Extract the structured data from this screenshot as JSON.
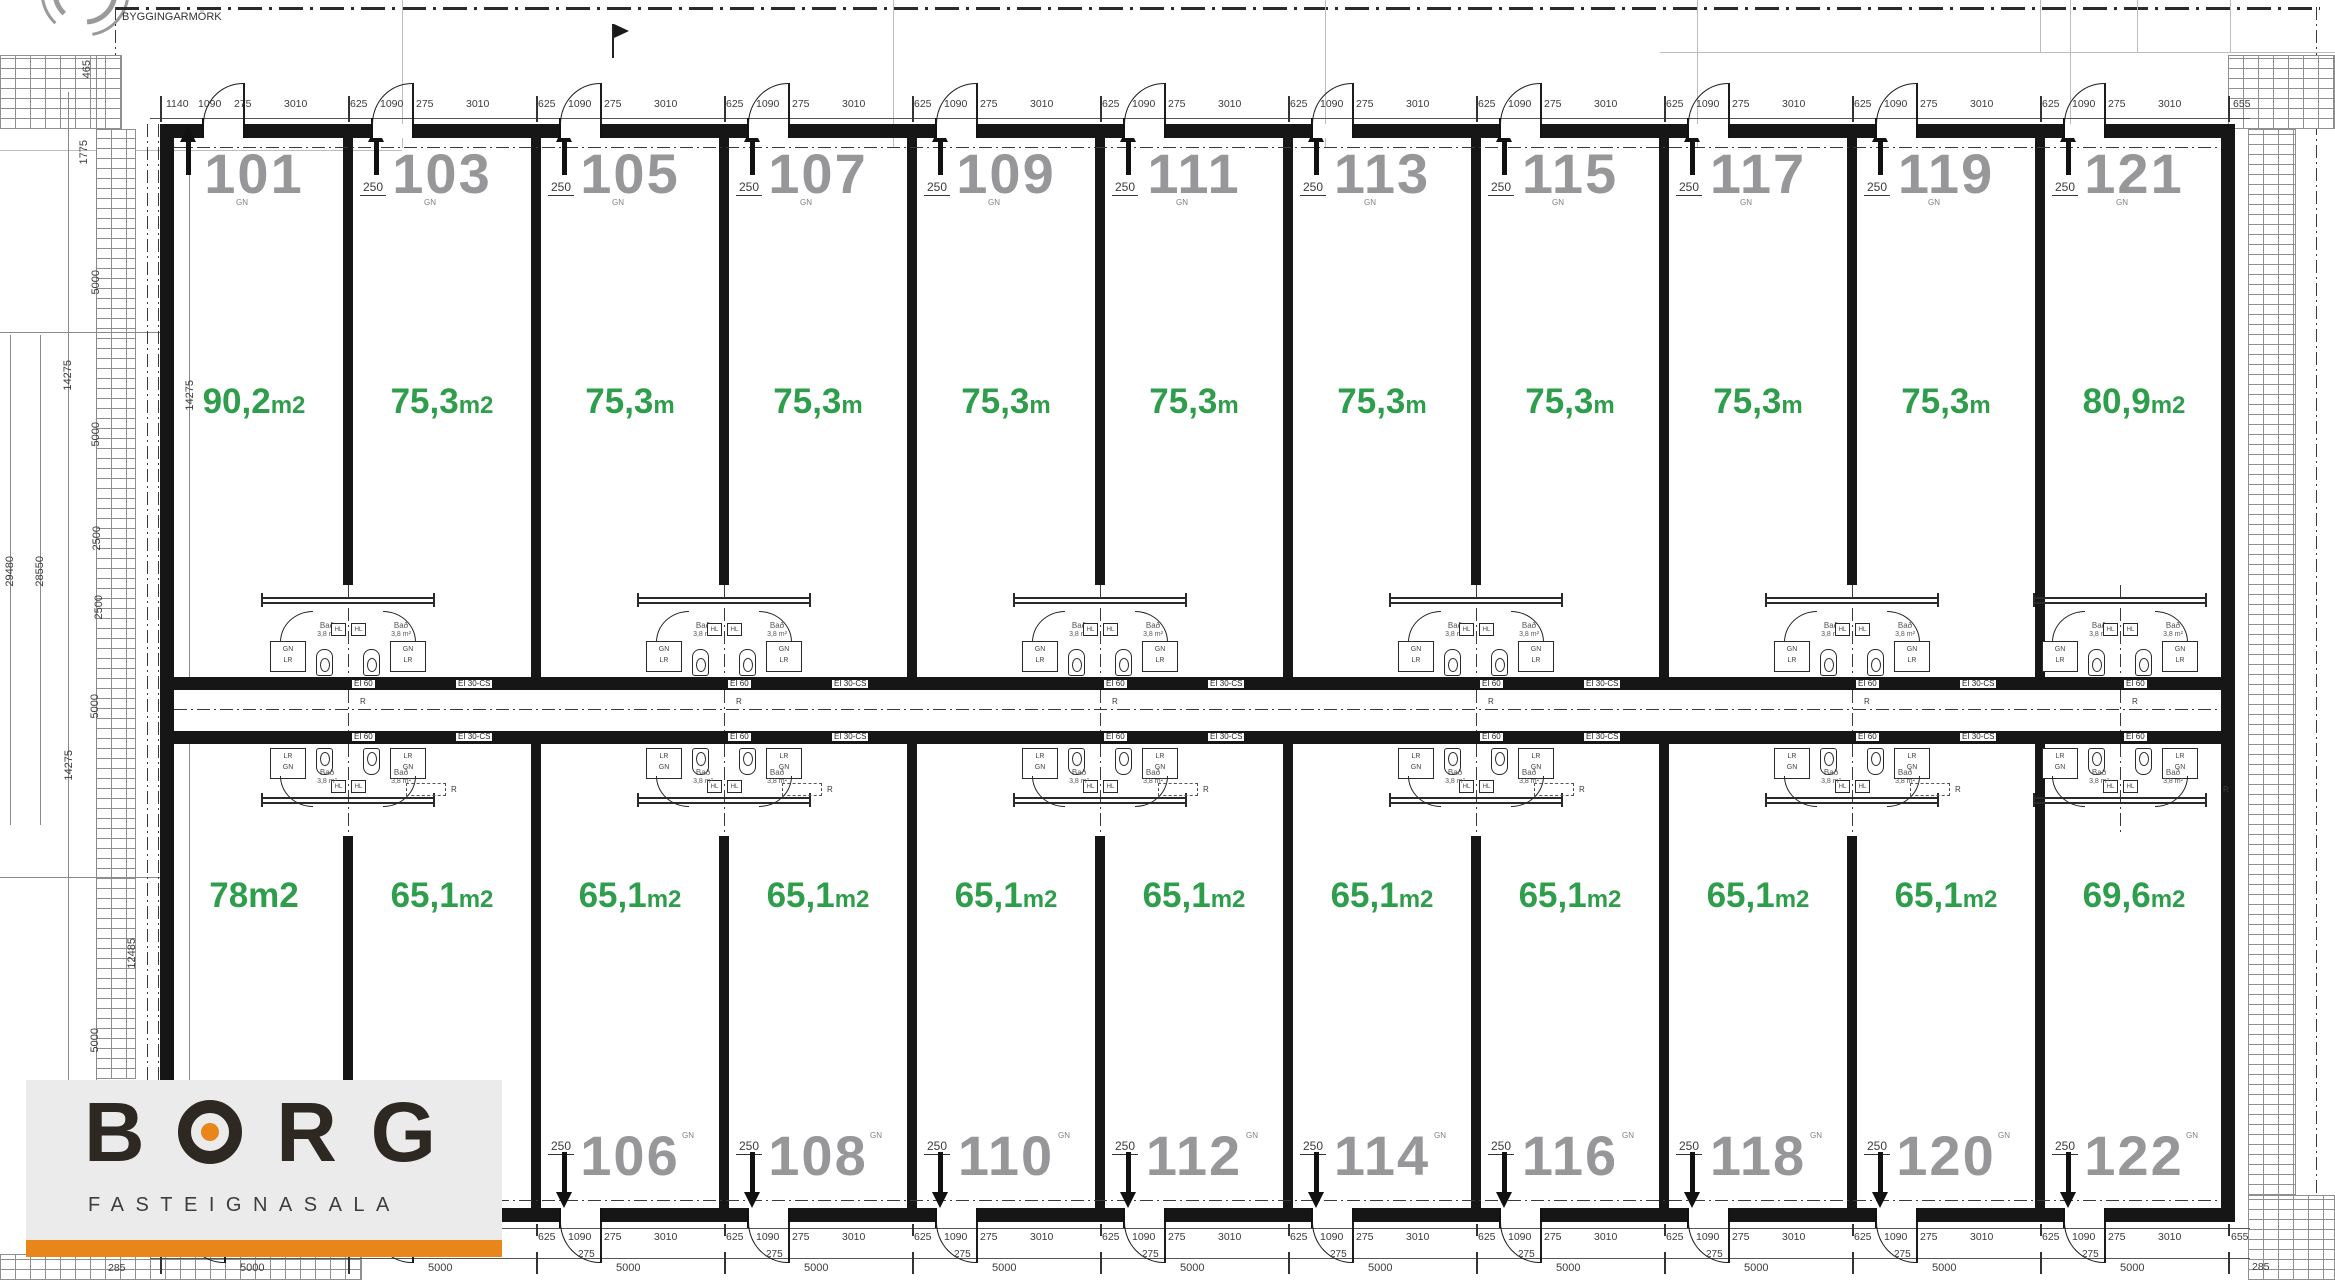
{
  "boundary": {
    "label": "BYGGINGARMÖRK"
  },
  "logo": {
    "name": "BORG",
    "subtitle": "FASTEIGNASALA",
    "accent_color": "#E8861C",
    "text_color": "#2E2823"
  },
  "colors": {
    "area_green": "#2F9E4C",
    "number_gray": "#97979A",
    "wall_black": "#161616"
  },
  "corridor": {
    "room_number": "0123",
    "room_name": "Gangur",
    "room_area": "72,8 m²",
    "width_dim": "1540",
    "fire_label_a": "EI 60",
    "fire_label_b": "EI 30-CS",
    "r_label": "R"
  },
  "bath_pod": {
    "room_name": "Bað",
    "room_area": "3,8 m²",
    "closet_a": "GN",
    "closet_b": "LR",
    "fixture_box": "HL"
  },
  "shared_dims": {
    "wall_dim": "250",
    "gn_label": "GN",
    "door_dim": "275",
    "unit_width_dim": "5000"
  },
  "top_row": {
    "units": [
      {
        "number": "101",
        "area_value": "90,2",
        "area_unit": "m2",
        "unit_small": true,
        "dims": [
          "1140",
          "1090",
          "275",
          "3010"
        ]
      },
      {
        "number": "103",
        "area_value": "75,3",
        "area_unit": "m2",
        "unit_small": true,
        "dims": [
          "625",
          "1090",
          "275",
          "3010"
        ]
      },
      {
        "number": "105",
        "area_value": "75,3",
        "area_unit": "m",
        "unit_small": true,
        "dims": [
          "625",
          "1090",
          "275",
          "3010"
        ]
      },
      {
        "number": "107",
        "area_value": "75,3",
        "area_unit": "m",
        "unit_small": true,
        "dims": [
          "625",
          "1090",
          "275",
          "3010"
        ]
      },
      {
        "number": "109",
        "area_value": "75,3",
        "area_unit": "m",
        "unit_small": true,
        "dims": [
          "625",
          "1090",
          "275",
          "3010"
        ]
      },
      {
        "number": "111",
        "area_value": "75,3",
        "area_unit": "m",
        "unit_small": true,
        "dims": [
          "625",
          "1090",
          "275",
          "3010"
        ]
      },
      {
        "number": "113",
        "area_value": "75,3",
        "area_unit": "m",
        "unit_small": true,
        "dims": [
          "625",
          "1090",
          "275",
          "3010"
        ]
      },
      {
        "number": "115",
        "area_value": "75,3",
        "area_unit": "m",
        "unit_small": true,
        "dims": [
          "625",
          "1090",
          "275",
          "3010"
        ]
      },
      {
        "number": "117",
        "area_value": "75,3",
        "area_unit": "m",
        "unit_small": true,
        "dims": [
          "625",
          "1090",
          "275",
          "3010"
        ]
      },
      {
        "number": "119",
        "area_value": "75,3",
        "area_unit": "m",
        "unit_small": true,
        "dims": [
          "625",
          "1090",
          "275",
          "3010"
        ]
      },
      {
        "number": "121",
        "area_value": "80,9",
        "area_unit": "m2",
        "unit_small": true,
        "dims": [
          "625",
          "1090",
          "275",
          "3010"
        ]
      }
    ]
  },
  "bottom_row": {
    "units": [
      {
        "number": "",
        "area_value": "78",
        "area_unit": "m2",
        "unit_small": false,
        "dims": [
          "625",
          "1090",
          "275",
          "3010"
        ]
      },
      {
        "number": "",
        "area_value": "65,1",
        "area_unit": "m2",
        "unit_small": true,
        "dims": [
          "625",
          "1090",
          "275",
          "3010"
        ]
      },
      {
        "number": "106",
        "area_value": "65,1",
        "area_unit": "m2",
        "unit_small": true,
        "dims": [
          "625",
          "1090",
          "275",
          "3010"
        ]
      },
      {
        "number": "108",
        "area_value": "65,1",
        "area_unit": "m2",
        "unit_small": true,
        "dims": [
          "625",
          "1090",
          "275",
          "3010"
        ]
      },
      {
        "number": "110",
        "area_value": "65,1",
        "area_unit": "m2",
        "unit_small": true,
        "dims": [
          "625",
          "1090",
          "275",
          "3010"
        ]
      },
      {
        "number": "112",
        "area_value": "65,1",
        "area_unit": "m2",
        "unit_small": true,
        "dims": [
          "625",
          "1090",
          "275",
          "3010"
        ]
      },
      {
        "number": "114",
        "area_value": "65,1",
        "area_unit": "m2",
        "unit_small": true,
        "dims": [
          "625",
          "1090",
          "275",
          "3010"
        ]
      },
      {
        "number": "116",
        "area_value": "65,1",
        "area_unit": "m2",
        "unit_small": true,
        "dims": [
          "625",
          "1090",
          "275",
          "3010"
        ]
      },
      {
        "number": "118",
        "area_value": "65,1",
        "area_unit": "m2",
        "unit_small": true,
        "dims": [
          "625",
          "1090",
          "275",
          "3010"
        ]
      },
      {
        "number": "120",
        "area_value": "65,1",
        "area_unit": "m2",
        "unit_small": true,
        "dims": [
          "625",
          "1090",
          "275",
          "3010"
        ]
      },
      {
        "number": "122",
        "area_value": "69,6",
        "area_unit": "m2",
        "unit_small": true,
        "dims": [
          "625",
          "1090",
          "275",
          "3010"
        ]
      }
    ]
  },
  "left_margin_dims": [
    "465",
    "1775",
    "5000",
    "14275",
    "5000",
    "2500",
    "2500",
    "5000",
    "14275",
    "12485",
    "5000",
    "29480",
    "28550",
    "14275"
  ],
  "corner_dims": {
    "bottom_left": "285",
    "bottom_right": "285",
    "top_right_end": "655",
    "bottom_right_end": "655"
  }
}
